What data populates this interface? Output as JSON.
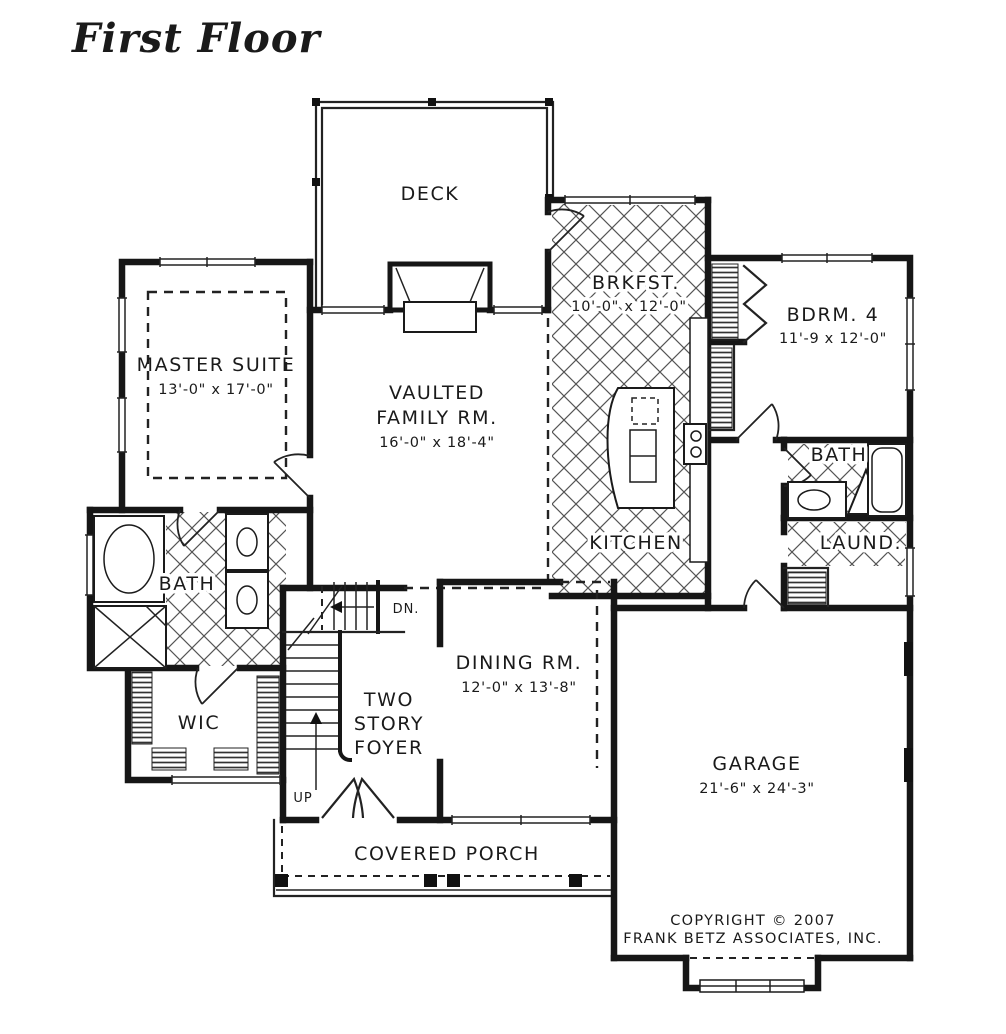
{
  "title": "First Floor",
  "colors": {
    "title": "#1E6F9E",
    "ink": "#1A1A1A"
  },
  "rooms": {
    "deck": {
      "label": "DECK"
    },
    "master_suite": {
      "label": "MASTER SUITE",
      "dims": "13'-0\" x 17'-0\""
    },
    "family": {
      "line1": "VAULTED",
      "line2": "FAMILY RM.",
      "dims": "16'-0\" x 18'-4\""
    },
    "breakfast": {
      "label": "BRKFST.",
      "dims": "10'-0\" x 12'-0\""
    },
    "bedroom4": {
      "label": "BDRM. 4",
      "dims": "11'-9 x 12'-0\""
    },
    "kitchen": {
      "label": "KITCHEN"
    },
    "bath_upper": {
      "label": "BATH"
    },
    "laundry": {
      "label": "LAUND."
    },
    "master_bath": {
      "label": "BATH"
    },
    "wic": {
      "label": "WIC"
    },
    "foyer": {
      "line1": "TWO",
      "line2": "STORY",
      "line3": "FOYER"
    },
    "dining": {
      "label": "DINING RM.",
      "dims": "12'-0\" x 13'-8\""
    },
    "garage": {
      "label": "GARAGE",
      "dims": "21'-6\" x 24'-3\""
    },
    "porch": {
      "label": "COVERED PORCH"
    }
  },
  "stairs": {
    "up": "UP",
    "down": "DN."
  },
  "copyright": {
    "line1": "COPYRIGHT © 2007",
    "line2": "FRANK BETZ ASSOCIATES, INC."
  }
}
